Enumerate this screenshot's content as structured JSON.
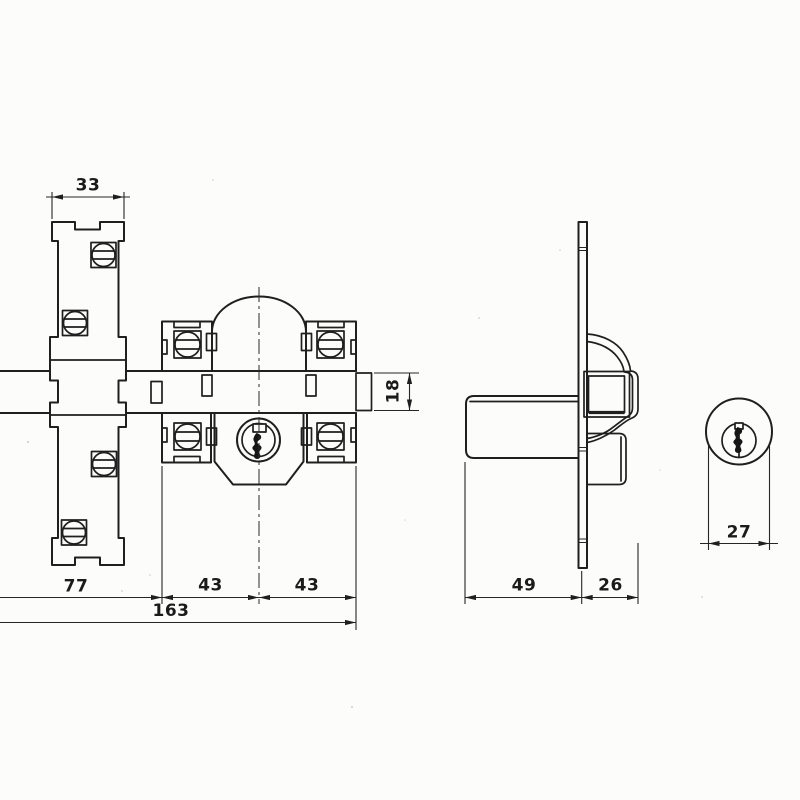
{
  "page": {
    "background": "#fcfcfb",
    "ink_color": "#1f1f1f"
  },
  "dimensions": {
    "strike_plate_width": "33",
    "bolt_height": "18",
    "left_segment": "77",
    "center_to_left_bracket": "43",
    "center_to_right_bracket": "43",
    "overall_length": "163",
    "cylinder_body_length": "49",
    "backplate_depth": "26",
    "cylinder_diameter": "27"
  }
}
